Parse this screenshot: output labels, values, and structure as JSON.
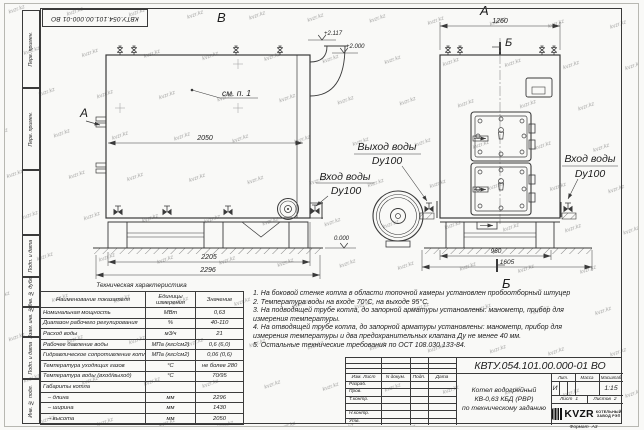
{
  "sheet": {
    "watermark": "kvzr.kz",
    "format_label": "Формат",
    "format_value": "А3"
  },
  "doc_number": "КВТУ.054.101.00.000-01 ВО",
  "margin_labels": [
    "Перв. примен.",
    "Перв. примен.",
    "",
    "Подп. и дата",
    "Инв. № дубл.",
    "Взам. инв. №",
    "Подп. и дата",
    "Инв. № подл."
  ],
  "drawing": {
    "left_view": {
      "label": "В",
      "view_arrow": "А",
      "note_ref": "см. п. 1",
      "dim_top": "2050",
      "dim_base": "2205",
      "dim_overall": "2296",
      "elev_flue": "+2.117",
      "elev_top": "+2.000",
      "elev_ground": "0.000",
      "inlet": {
        "line1": "Вход воды",
        "line2": "Dy100"
      }
    },
    "right_view": {
      "label": "А",
      "section_mark": "Б",
      "dim_top": "1260",
      "dim_base": "960",
      "dim_overall": "1605",
      "outlet": {
        "line1": "Выход воды",
        "line2": "Dy100"
      },
      "inlet": {
        "line1": "Вход воды",
        "line2": "Dy100"
      }
    }
  },
  "tech_table": {
    "title": "Техническая характеристика",
    "headers": [
      "Наименование показателя",
      "Единицы измерения",
      "Значение"
    ],
    "rows": [
      [
        "Номинальная мощность",
        "МВт",
        "0,63"
      ],
      [
        "Диапазон рабочего регулирования",
        "%",
        "40-110"
      ],
      [
        "Расход воды",
        "м3/ч",
        "21"
      ],
      [
        "Рабочее давление воды",
        "МПа (кгс/см2)",
        "0,6 (6,0)"
      ],
      [
        "Гидравлическое сопротивление котла",
        "МПа (кгс/см2)",
        "0,06 (0,6)"
      ],
      [
        "Температура уходящих газов",
        "°С",
        "не более 280"
      ],
      [
        "Температура воды (вход/выход)",
        "°С",
        "70/95"
      ],
      [
        "Габариты котла",
        "",
        ""
      ],
      [
        "   – длина",
        "мм",
        "2296"
      ],
      [
        "   – ширина",
        "мм",
        "1430"
      ],
      [
        "   – высота",
        "мм",
        "2050"
      ]
    ]
  },
  "notes": {
    "items": [
      "1. На боковой стенке котла в области топочной камеры установлен пробоотборный штуцер",
      "2. Температура воды на входе 70°С, на выходе 95°С.",
      "3. На подводящей трубе котла, до запорной арматуры установлены: манометр, прибор для измерения температуры.",
      "4. На отводящей трубе котла, до запорной арматуры установлены: манометр, прибор для измерения температуры и два предохранительных клапана Ду не менее 40 мм.",
      "5. Остальные технические требования по ОСТ 108.030.133-84."
    ]
  },
  "title_block": {
    "header_cols": [
      "Изм. Лист",
      "N докум.",
      "Подп.",
      "Дата"
    ],
    "row_labels": [
      "Разраб.",
      "Пров.",
      "Т.контр.",
      "",
      "Н.контр.",
      "Утв."
    ],
    "title_lines": [
      "Котел водогрейный",
      "КВ-0,63 КБД (РВР)",
      "по техническому заданию"
    ],
    "lit_label": "Лит.",
    "mass_label": "Масса",
    "scale_label": "Масштаб",
    "lit_value": "И",
    "scale_value": "1:15",
    "sheet_label": "Лист",
    "sheet_value": "1",
    "sheets_label": "Листов",
    "sheets_value": "2",
    "company": {
      "logo_text": "KVZR",
      "line1": "КОТЕЛЬНЫЙ",
      "line2": "ЗАВОД РЭП"
    }
  }
}
